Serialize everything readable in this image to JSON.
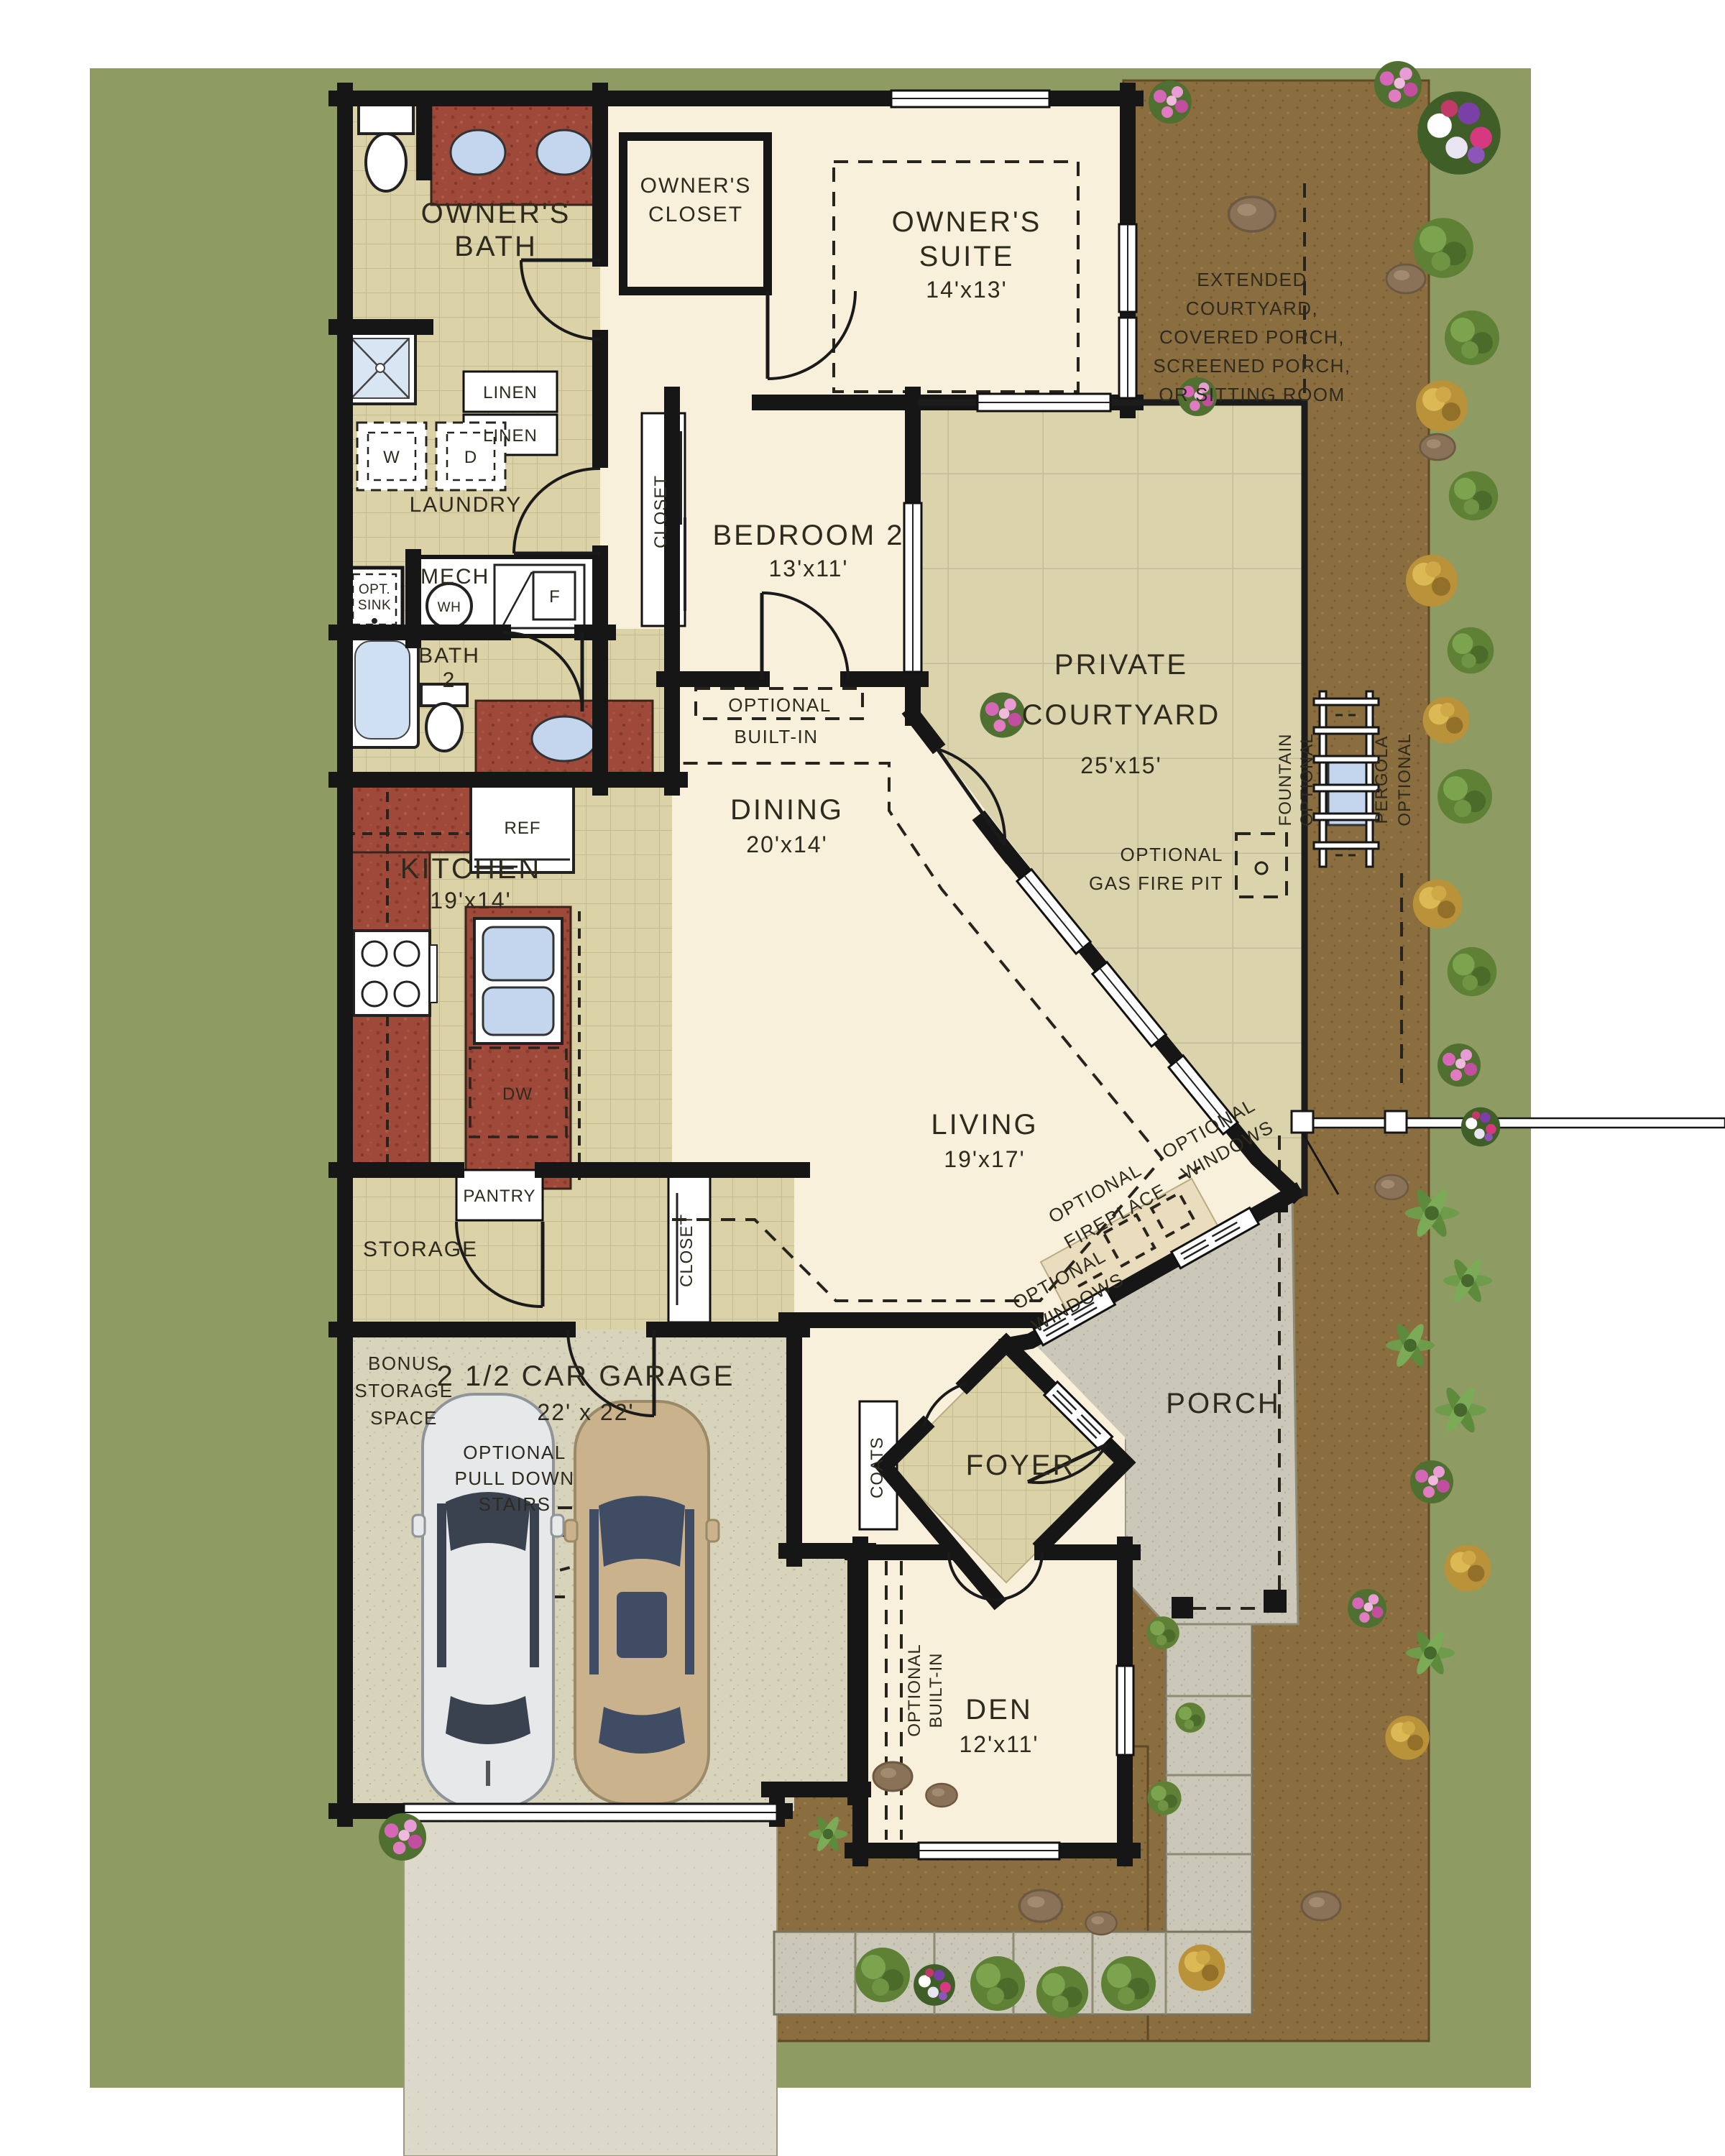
{
  "plan_title": "single-story floor plan",
  "labels": {
    "owners_bath": [
      "OWNER'S",
      "BATH"
    ],
    "owners_closet": [
      "OWNER'S",
      "CLOSET"
    ],
    "owners_suite": [
      "OWNER'S",
      "SUITE",
      "14'x13'"
    ],
    "linen_a": "LINEN",
    "linen_b": "LINEN",
    "laundry": "LAUNDRY",
    "washer": "W",
    "dryer": "D",
    "mech": "MECH",
    "water_heater": "WH",
    "furnace": "F",
    "opt_sink": [
      "OPT.",
      "SINK"
    ],
    "bath2": [
      "BATH",
      "2"
    ],
    "bedroom2": [
      "BEDROOM 2",
      "13'x11'"
    ],
    "closet_bedroom2": "CLOSET",
    "private_courtyard": [
      "PRIVATE",
      "COURTYARD",
      "25'x15'"
    ],
    "extended_courtyard": [
      "EXTENDED",
      "COURTYARD,",
      "COVERED PORCH,",
      "SCREENED PORCH,",
      "OR SITTING ROOM"
    ],
    "optional_fountain": [
      "OPTIONAL",
      "FOUNTAIN"
    ],
    "optional_pergola": [
      "OPTIONAL",
      "PERGOLA"
    ],
    "optional_built_in_dining": [
      "OPTIONAL",
      "BUILT-IN"
    ],
    "ref": "REF",
    "kitchen": [
      "KITCHEN",
      "19'x14'"
    ],
    "dining": [
      "DINING",
      "20'x14'"
    ],
    "optional_gas_fire_pit": [
      "OPTIONAL",
      "GAS FIRE PIT"
    ],
    "dw": "DW",
    "living": [
      "LIVING",
      "19'x17'"
    ],
    "optional_fireplace": [
      "OPTIONAL",
      "FIREPLACE"
    ],
    "optional_windows_a": [
      "OPTIONAL",
      "WINDOWS"
    ],
    "optional_windows_b": [
      "OPTIONAL",
      "WINDOWS"
    ],
    "pantry": "PANTRY",
    "storage": "STORAGE",
    "closet_hall": "CLOSET",
    "bonus_storage": [
      "BONUS",
      "STORAGE",
      "SPACE"
    ],
    "garage": [
      "2 1/2 CAR GARAGE",
      "22' x 22'"
    ],
    "pull_down_stairs": [
      "OPTIONAL",
      "PULL DOWN",
      "STAIRS"
    ],
    "coats": "COATS",
    "foyer": "FOYER",
    "porch": "PORCH",
    "den": [
      "DEN",
      "12'x11'"
    ],
    "optional_built_in_den": [
      "OPTIONAL",
      "BUILT-IN"
    ]
  },
  "colors": {
    "background": "#ffffff",
    "lawn_olive": "#8e9b62",
    "dirt_brown": "#8b6e3f",
    "house_cream": "#f8f0da",
    "tile_beige": "#dcd2a8",
    "courtyard_tile": "#dbd3ac",
    "counter_brick": "#9e4939",
    "water_blue": "#c3d6ee",
    "garage_floor": "#d8d4bc",
    "porch_gray": "#cbc8b9",
    "driveway_gray": "#dcd9cb",
    "wall_black": "#161616"
  }
}
